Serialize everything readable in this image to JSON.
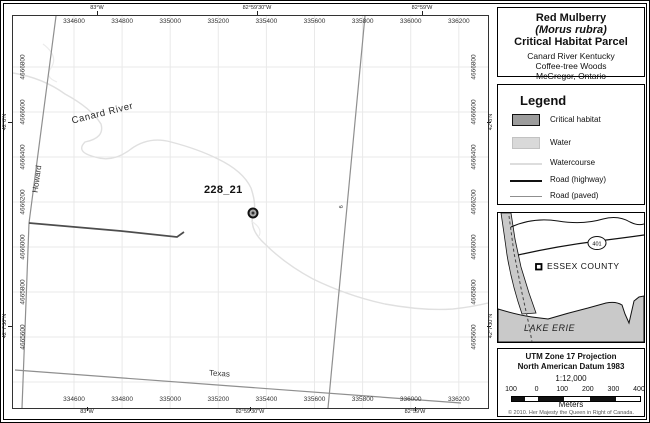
{
  "title_block": {
    "line1": "Red Mulberry",
    "line2": "(Morus rubra)",
    "line3": "Critical Habitat Parcel",
    "sub1": "Canard River Kentucky",
    "sub2": "Coffee-tree Woods",
    "sub3": "McGregor, Ontario"
  },
  "legend": {
    "title": "Legend",
    "items": [
      {
        "label": "Critical habitat",
        "swatch": "fill-dark"
      },
      {
        "label": "Water",
        "swatch": "fill-light"
      },
      {
        "label": "Watercourse",
        "swatch": "line-faint"
      },
      {
        "label": "Road (highway)",
        "swatch": "line-black"
      },
      {
        "label": "Road (paved)",
        "swatch": "line-gray"
      }
    ]
  },
  "inset": {
    "county_label": "ESSEX COUNTY",
    "lake_label": "LAKE ERIE",
    "highway_shield": "401"
  },
  "scale_info": {
    "projection": "UTM Zone 17 Projection",
    "datum": "North American Datum 1983",
    "ratio": "1:12,000",
    "bar_labels": [
      "100",
      "0",
      "100",
      "200",
      "300",
      "400"
    ],
    "unit": "Meters",
    "copyright": "© 2010. Her Majesty the Queen in Right of Canada."
  },
  "map": {
    "parcel_label": "228_21",
    "road_labels": {
      "canard_river": "Canard River",
      "howard": "Howard",
      "texas": "Texas",
      "road9": "9"
    },
    "grid": {
      "eastings": [
        "334600",
        "334800",
        "335000",
        "335200",
        "335400",
        "335600",
        "335800",
        "336000",
        "336200"
      ],
      "northings": [
        "4666800",
        "4666600",
        "4666400",
        "4666200",
        "4666000",
        "4665800",
        "4665600"
      ],
      "lon_labels": [
        "83°W",
        "82°59'30\"W",
        "82°59'W"
      ],
      "lat_labels": [
        "42°8'N",
        "42°7'30\"N"
      ]
    }
  },
  "colors": {
    "critical_habitat": "#9c9c9c",
    "water": "#c9c9c9",
    "water_swatch": "#d9d9d9",
    "watercourse": "#dddddd",
    "road_highway": "#111111",
    "road_paved": "#8f8f8f",
    "road_dark": "#4d4d4d",
    "gridline": "#e9e9e9"
  }
}
